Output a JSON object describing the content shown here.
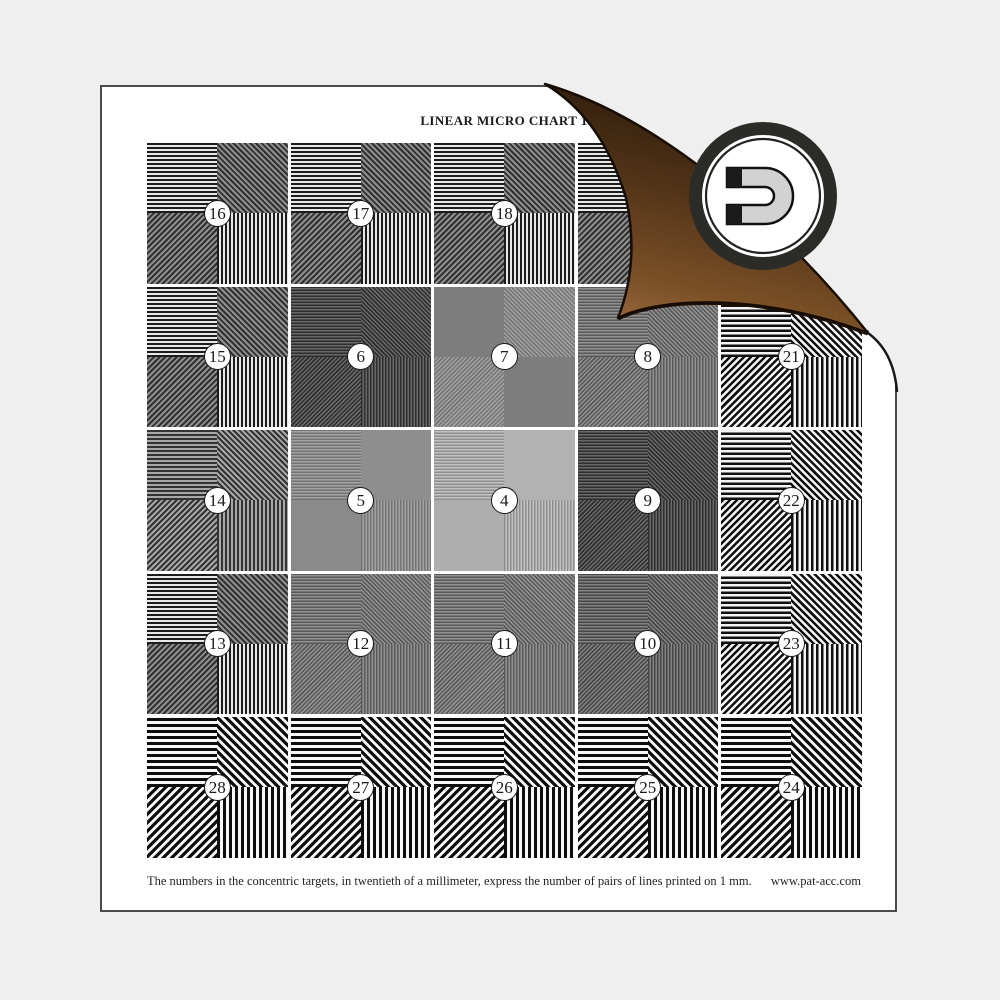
{
  "page": {
    "title": "LINEAR MICRO CHART 1",
    "caption": "The numbers in the concentric targets, in twentieth of a millimeter, express the number of pairs of lines printed on 1 mm.",
    "website": "www.pat-acc.com"
  },
  "logo": {
    "name": "magnet-logo",
    "shape": "horseshoe magnet opening left inside double ring"
  },
  "colors": {
    "background": "#efefef",
    "page": "#ffffff",
    "page_border": "#4a4a4a",
    "ink": "#1a1a1a",
    "curl_outline": "#170d04",
    "curl_shadow": "#1d1006",
    "curl_gradient": [
      "#261607",
      "#523419",
      "#7b5026",
      "#9a6a3e"
    ],
    "logo_ring": "#2b2b28",
    "logo_inner_ring": "#222222",
    "logo_face": "#ffffff",
    "magnet_body": "#d2d2d2",
    "magnet_outline": "#111111",
    "magnet_poles": "#1b1b1b"
  },
  "grid": {
    "rows": 5,
    "cols": 5,
    "quadrants": [
      {
        "pos": "tl",
        "orientation": "horizontal-lines",
        "angle": 0
      },
      {
        "pos": "tr",
        "orientation": "diagonal-backslash-lines",
        "angle": 45
      },
      {
        "pos": "bl",
        "orientation": "diagonal-slash-lines",
        "angle": 135
      },
      {
        "pos": "br",
        "orientation": "vertical-lines",
        "angle": 90
      }
    ],
    "presets": {
      "med": {
        "p": 4,
        "a": "#1c1c1c",
        "b": "#e8e8e8",
        "diag": {
          "a": "#303030",
          "b": "#8f8f8f"
        }
      },
      "medGray": {
        "p": 4,
        "a": "#333333",
        "b": "#a8a8a8"
      },
      "fineDark": {
        "p": 3,
        "a": "#2e2e2e",
        "b": "#686868"
      },
      "fineMid": {
        "p": 3,
        "a": "#595959",
        "b": "#919191"
      },
      "fineMidDark": {
        "p": 3,
        "a": "#474747",
        "b": "#828282"
      },
      "fineSoft": {
        "p": 3,
        "a": "#747474",
        "b": "#a2a2a2"
      },
      "fineLight": {
        "p": 3,
        "a": "#8f8f8f",
        "b": "#c2c2c2"
      },
      "coarse5": {
        "p": 5,
        "a": "#101010",
        "b": "#f4f4f4"
      },
      "coarse": {
        "p": 6,
        "a": "#0d0d0d",
        "b": "#f8f8f8"
      }
    },
    "cells": [
      {
        "row": 0,
        "col": 0,
        "num": "16",
        "style": "med",
        "q": [
          null,
          null,
          null,
          null
        ]
      },
      {
        "row": 0,
        "col": 1,
        "num": "17",
        "style": "med",
        "q": [
          null,
          null,
          null,
          null
        ]
      },
      {
        "row": 0,
        "col": 2,
        "num": "18",
        "style": "med",
        "q": [
          null,
          null,
          null,
          null
        ]
      },
      {
        "row": 0,
        "col": 3,
        "num": null,
        "style": "med",
        "q": [
          null,
          null,
          null,
          null
        ]
      },
      {
        "row": 0,
        "col": 4,
        "num": null,
        "style": "med",
        "q": [
          null,
          null,
          null,
          null
        ]
      },
      {
        "row": 1,
        "col": 0,
        "num": "15",
        "style": "med",
        "q": [
          null,
          null,
          null,
          null
        ]
      },
      {
        "row": 1,
        "col": 1,
        "num": "6",
        "style": "fineDark",
        "q": [
          null,
          null,
          null,
          null
        ]
      },
      {
        "row": 1,
        "col": 2,
        "num": "7",
        "style": "fineSoft",
        "q": [
          {
            "flat": "#7d7d7d"
          },
          null,
          null,
          {
            "flat": "#7d7d7d"
          }
        ]
      },
      {
        "row": 1,
        "col": 3,
        "num": "8",
        "style": "fineMid",
        "q": [
          null,
          null,
          null,
          null
        ]
      },
      {
        "row": 1,
        "col": 4,
        "num": "21",
        "style": "coarse5",
        "q": [
          null,
          null,
          null,
          null
        ]
      },
      {
        "row": 2,
        "col": 0,
        "num": "14",
        "style": "medGray",
        "q": [
          null,
          null,
          null,
          null
        ]
      },
      {
        "row": 2,
        "col": 1,
        "num": "5",
        "style": "fineSoft",
        "q": [
          null,
          {
            "flat": "#8e8e8e"
          },
          {
            "flat": "#8a8a8a"
          },
          null
        ]
      },
      {
        "row": 2,
        "col": 2,
        "num": "4",
        "style": "fineLight",
        "q": [
          null,
          {
            "flat": "#b2b2b2"
          },
          {
            "flat": "#aeaeae"
          },
          null
        ]
      },
      {
        "row": 2,
        "col": 3,
        "num": "9",
        "style": "fineDark",
        "q": [
          null,
          null,
          null,
          null
        ]
      },
      {
        "row": 2,
        "col": 4,
        "num": "22",
        "style": "coarse5",
        "q": [
          null,
          null,
          null,
          null
        ]
      },
      {
        "row": 3,
        "col": 0,
        "num": "13",
        "style": "med",
        "q": [
          null,
          null,
          null,
          null
        ]
      },
      {
        "row": 3,
        "col": 1,
        "num": "12",
        "style": "fineMid",
        "q": [
          null,
          null,
          null,
          null
        ]
      },
      {
        "row": 3,
        "col": 2,
        "num": "11",
        "style": "fineMid",
        "q": [
          null,
          null,
          null,
          null
        ]
      },
      {
        "row": 3,
        "col": 3,
        "num": "10",
        "style": "fineMidDark",
        "q": [
          null,
          null,
          null,
          null
        ]
      },
      {
        "row": 3,
        "col": 4,
        "num": "23",
        "style": "coarse5",
        "q": [
          null,
          null,
          null,
          null
        ]
      },
      {
        "row": 4,
        "col": 0,
        "num": "28",
        "style": "coarse",
        "q": [
          null,
          null,
          null,
          null
        ]
      },
      {
        "row": 4,
        "col": 1,
        "num": "27",
        "style": "coarse",
        "q": [
          null,
          null,
          null,
          null
        ]
      },
      {
        "row": 4,
        "col": 2,
        "num": "26",
        "style": "coarse",
        "q": [
          null,
          null,
          null,
          null
        ]
      },
      {
        "row": 4,
        "col": 3,
        "num": "25",
        "style": "coarse",
        "q": [
          null,
          null,
          null,
          null
        ]
      },
      {
        "row": 4,
        "col": 4,
        "num": "24",
        "style": "coarse",
        "q": [
          null,
          null,
          null,
          null
        ]
      }
    ]
  }
}
